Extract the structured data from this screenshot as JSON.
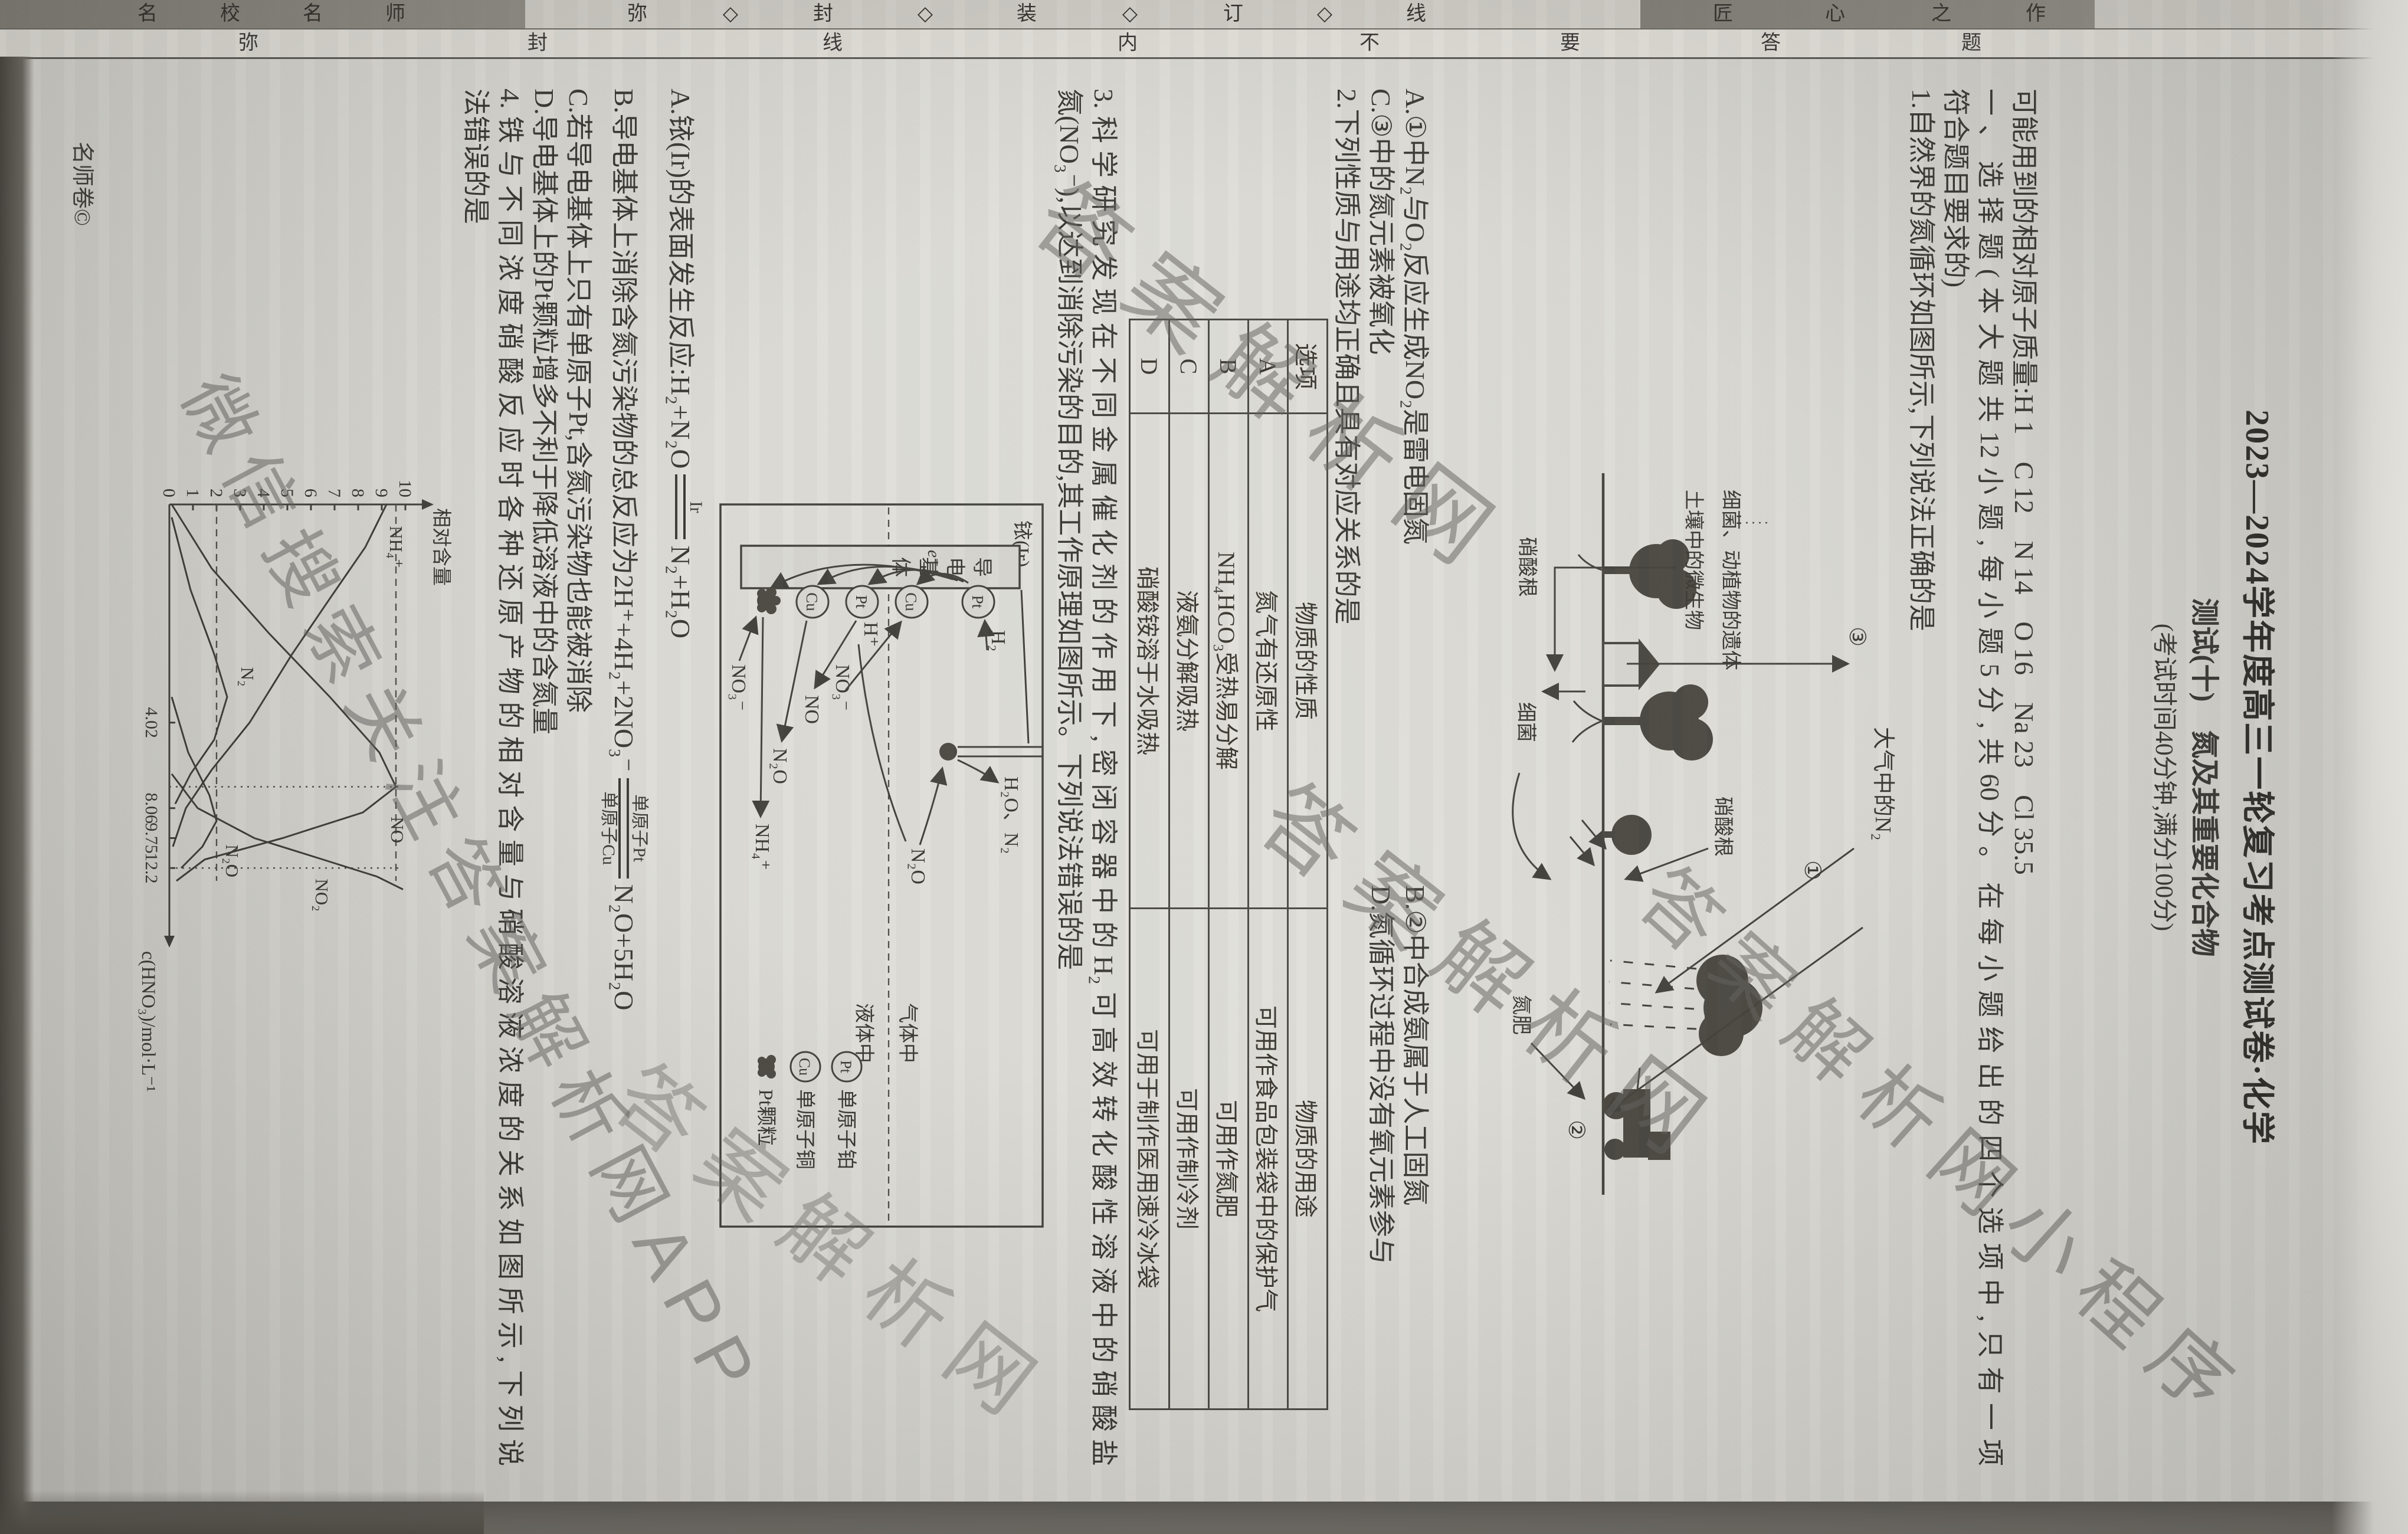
{
  "bands": {
    "maker_label": "名校名师",
    "seal_label": "弥封装订线",
    "brand_label": "匠心之作",
    "inner_label": "弥封线内不要答题",
    "maker": [
      "师",
      "名",
      "校",
      "名"
    ],
    "seal": [
      "线",
      "◇",
      "订",
      "◇",
      "装",
      "◇",
      "封",
      "◇",
      "弥"
    ],
    "brand": [
      "作",
      "之",
      "心",
      "匠"
    ],
    "inner": [
      "题",
      "答",
      "要",
      "不",
      "内",
      "线",
      "封",
      "弥"
    ]
  },
  "header": {
    "title": "2023—2024学年度高三一轮复习考点测试卷·化学",
    "subtitle": "测试(十)　氮及其重要化合物",
    "exam_info": "(考试时间40分钟,满分100分)",
    "atomic_mass": "可能用到的相对原子质量:H 1　C 12　N 14　O 16　Na 23　Cl 35.5",
    "section_line1": "一、选择题(本大题共12小题,每小题5分,共60分。在每小题给出的四个选项中,只有一项",
    "section_line2": "符合题目要求的)"
  },
  "q1": {
    "stem": "1.自然界的氮循环如图所示,下列说法正确的是",
    "options": [
      "A.①中N₂与O₂反应生成NO₂是雷电固氮",
      "B.②中合成氨属于人工固氮",
      "C.③中的氮元素被氧化",
      "D.氮循环过程中没有氧元素参与"
    ],
    "figure": {
      "atm": "大气中的N₂",
      "c1": "①",
      "c2": "②",
      "c3": "③",
      "nitrate_rain": "硝酸根",
      "nitrate_soil": "硝酸根",
      "bacteria": "细菌",
      "remains": "细菌、动植物的遗体",
      "microbes": "土壤中的微生物",
      "fertilizer": "氮肥"
    }
  },
  "q2": {
    "stem": "2.下列性质与用途均正确且具有对应关系的是",
    "table": {
      "headers": [
        "选项",
        "物质的性质",
        "物质的用途"
      ],
      "rows": [
        {
          "opt": "A",
          "prop": "氮气有还原性",
          "use": "可用作食品包装袋中的保护气"
        },
        {
          "opt": "B",
          "prop": "NH₄HCO₃受热易分解",
          "use": "可用作氮肥"
        },
        {
          "opt": "C",
          "prop": "液氨分解吸热",
          "use": "可用作制冷剂"
        },
        {
          "opt": "D",
          "prop": "硝酸铵溶于水吸热",
          "use": "可用于制作医用速冷冰袋"
        }
      ]
    }
  },
  "q3": {
    "stem_line1": "3.科学研究发现在不同金属催化剂的作用下,密闭容器中的H₂可高效转化酸性溶液中的硝酸盐",
    "stem_line2": "氮(NO₃⁻),以达到消除污染的目的,其工作原理如图所示。下列说法错误的是",
    "optionA": {
      "pre": "A.铱(Ir)的表面发生反应:H₂+N₂O",
      "over": "Ir",
      "post": "N₂+H₂O"
    },
    "optionB": {
      "pre": "B.导电基体上消除含氮污染物的总反应为2H⁺+4H₂+2NO₃⁻",
      "over": "单原子Pt",
      "under": "单原子Cu",
      "post": "N₂O+5H₂O"
    },
    "optionC": "C.若导电基体上只有单原子Pt,含氮污染物也能被消除",
    "optionD": "D.导电基体上的Pt颗粒增多不利于降低溶液中的含氮量",
    "figure": {
      "ir": "铱(Ir)",
      "gas": "气体中",
      "liquid": "液体中",
      "base": [
        "导",
        "电",
        "基",
        "体"
      ],
      "e": "e⁻",
      "h2": "H₂",
      "h2o_n2": "H₂O、N₂",
      "n2o_gas": "N₂O",
      "h_plus": "H⁺",
      "no3_a": "NO₃⁻",
      "no": "NO",
      "n2o_liq": "N₂O",
      "nh4": "NH₄⁺",
      "no3_b": "NO₃⁻",
      "sites": [
        "Pt",
        "Cu",
        "Pt",
        "Cu"
      ],
      "leg_pt": "Pt",
      "leg_cu": "Cu",
      "leg1": "单原子铂",
      "leg2": "单原子铜",
      "leg3": "Pt颗粒"
    }
  },
  "q4": {
    "stem_line1": "4.铁与不同浓度硝酸反应时各种还原产物的相对含量与硝酸溶液浓度的关系如图所示,下列说",
    "stem_line2": "法错误的是"
  },
  "chart_data": {
    "type": "line",
    "title": "",
    "xlabel": "c(HNO₃)/mol·L⁻¹",
    "ylabel": "相对含量",
    "ylim": [
      0,
      10
    ],
    "grid": false,
    "legend_position": "inline-labels",
    "y_ticks": [
      0,
      1,
      2,
      3,
      4,
      5,
      6,
      7,
      8,
      9,
      10
    ],
    "x_ticks": [
      {
        "label": "4.02",
        "frac": 0.51
      },
      {
        "label": "8.06",
        "frac": 0.71
      },
      {
        "label": "9.75",
        "frac": 0.78
      },
      {
        "label": "12.2",
        "frac": 0.85
      }
    ],
    "series": [
      {
        "name": "NH₄⁺",
        "label_pos": [
          0.05,
          9.35
        ],
        "points": [
          [
            0,
            9.2
          ],
          [
            0.1,
            8.3
          ],
          [
            0.22,
            6.8
          ],
          [
            0.35,
            5.2
          ],
          [
            0.51,
            3.4
          ],
          [
            0.62,
            1.8
          ],
          [
            0.71,
            0.7
          ],
          [
            0.8,
            0.15
          ]
        ]
      },
      {
        "name": "NO",
        "label_pos": [
          0.73,
          9.4
        ],
        "points": [
          [
            0,
            0.1
          ],
          [
            0.15,
            1.8
          ],
          [
            0.3,
            4.2
          ],
          [
            0.45,
            6.8
          ],
          [
            0.58,
            8.9
          ],
          [
            0.66,
            9.6
          ],
          [
            0.72,
            8.2
          ],
          [
            0.78,
            4.8
          ],
          [
            0.83,
            1.5
          ],
          [
            0.88,
            0.3
          ]
        ]
      },
      {
        "name": "N₂",
        "label_pos": [
          0.38,
          3.05
        ],
        "points": [
          [
            0.03,
            0.1
          ],
          [
            0.2,
            0.9
          ],
          [
            0.35,
            1.9
          ],
          [
            0.45,
            2.45
          ],
          [
            0.55,
            1.9
          ],
          [
            0.63,
            0.9
          ],
          [
            0.7,
            0.25
          ]
        ]
      },
      {
        "name": "N₂O",
        "label_pos": [
          0.795,
          2.4
        ],
        "points": [
          [
            0.45,
            0.1
          ],
          [
            0.58,
            0.8
          ],
          [
            0.68,
            1.7
          ],
          [
            0.74,
            2.0
          ],
          [
            0.8,
            1.4
          ],
          [
            0.85,
            0.5
          ]
        ]
      },
      {
        "name": "NO₂",
        "label_pos": [
          0.875,
          6.2
        ],
        "points": [
          [
            0.63,
            0.1
          ],
          [
            0.71,
            1.2
          ],
          [
            0.78,
            3.6
          ],
          [
            0.83,
            6.5
          ],
          [
            0.87,
            8.8
          ],
          [
            0.9,
            9.9
          ]
        ]
      }
    ],
    "guides": {
      "v_fracs": [
        0.66,
        0.85
      ],
      "h_values": [
        9.6,
        2.0
      ]
    }
  },
  "footer": {
    "imprint": "名师卷©"
  },
  "watermarks": {
    "w1": "答案解析网",
    "w2": "微信搜索关注答案解析网APP",
    "w3": "答案解析网",
    "w4": "答案解析网小程序",
    "w5": "答案解析网"
  },
  "colors": {
    "paper": "#dcdbd5",
    "band_dark": "#86847c",
    "ink": "#35332f",
    "watermark": "#605e5a"
  }
}
